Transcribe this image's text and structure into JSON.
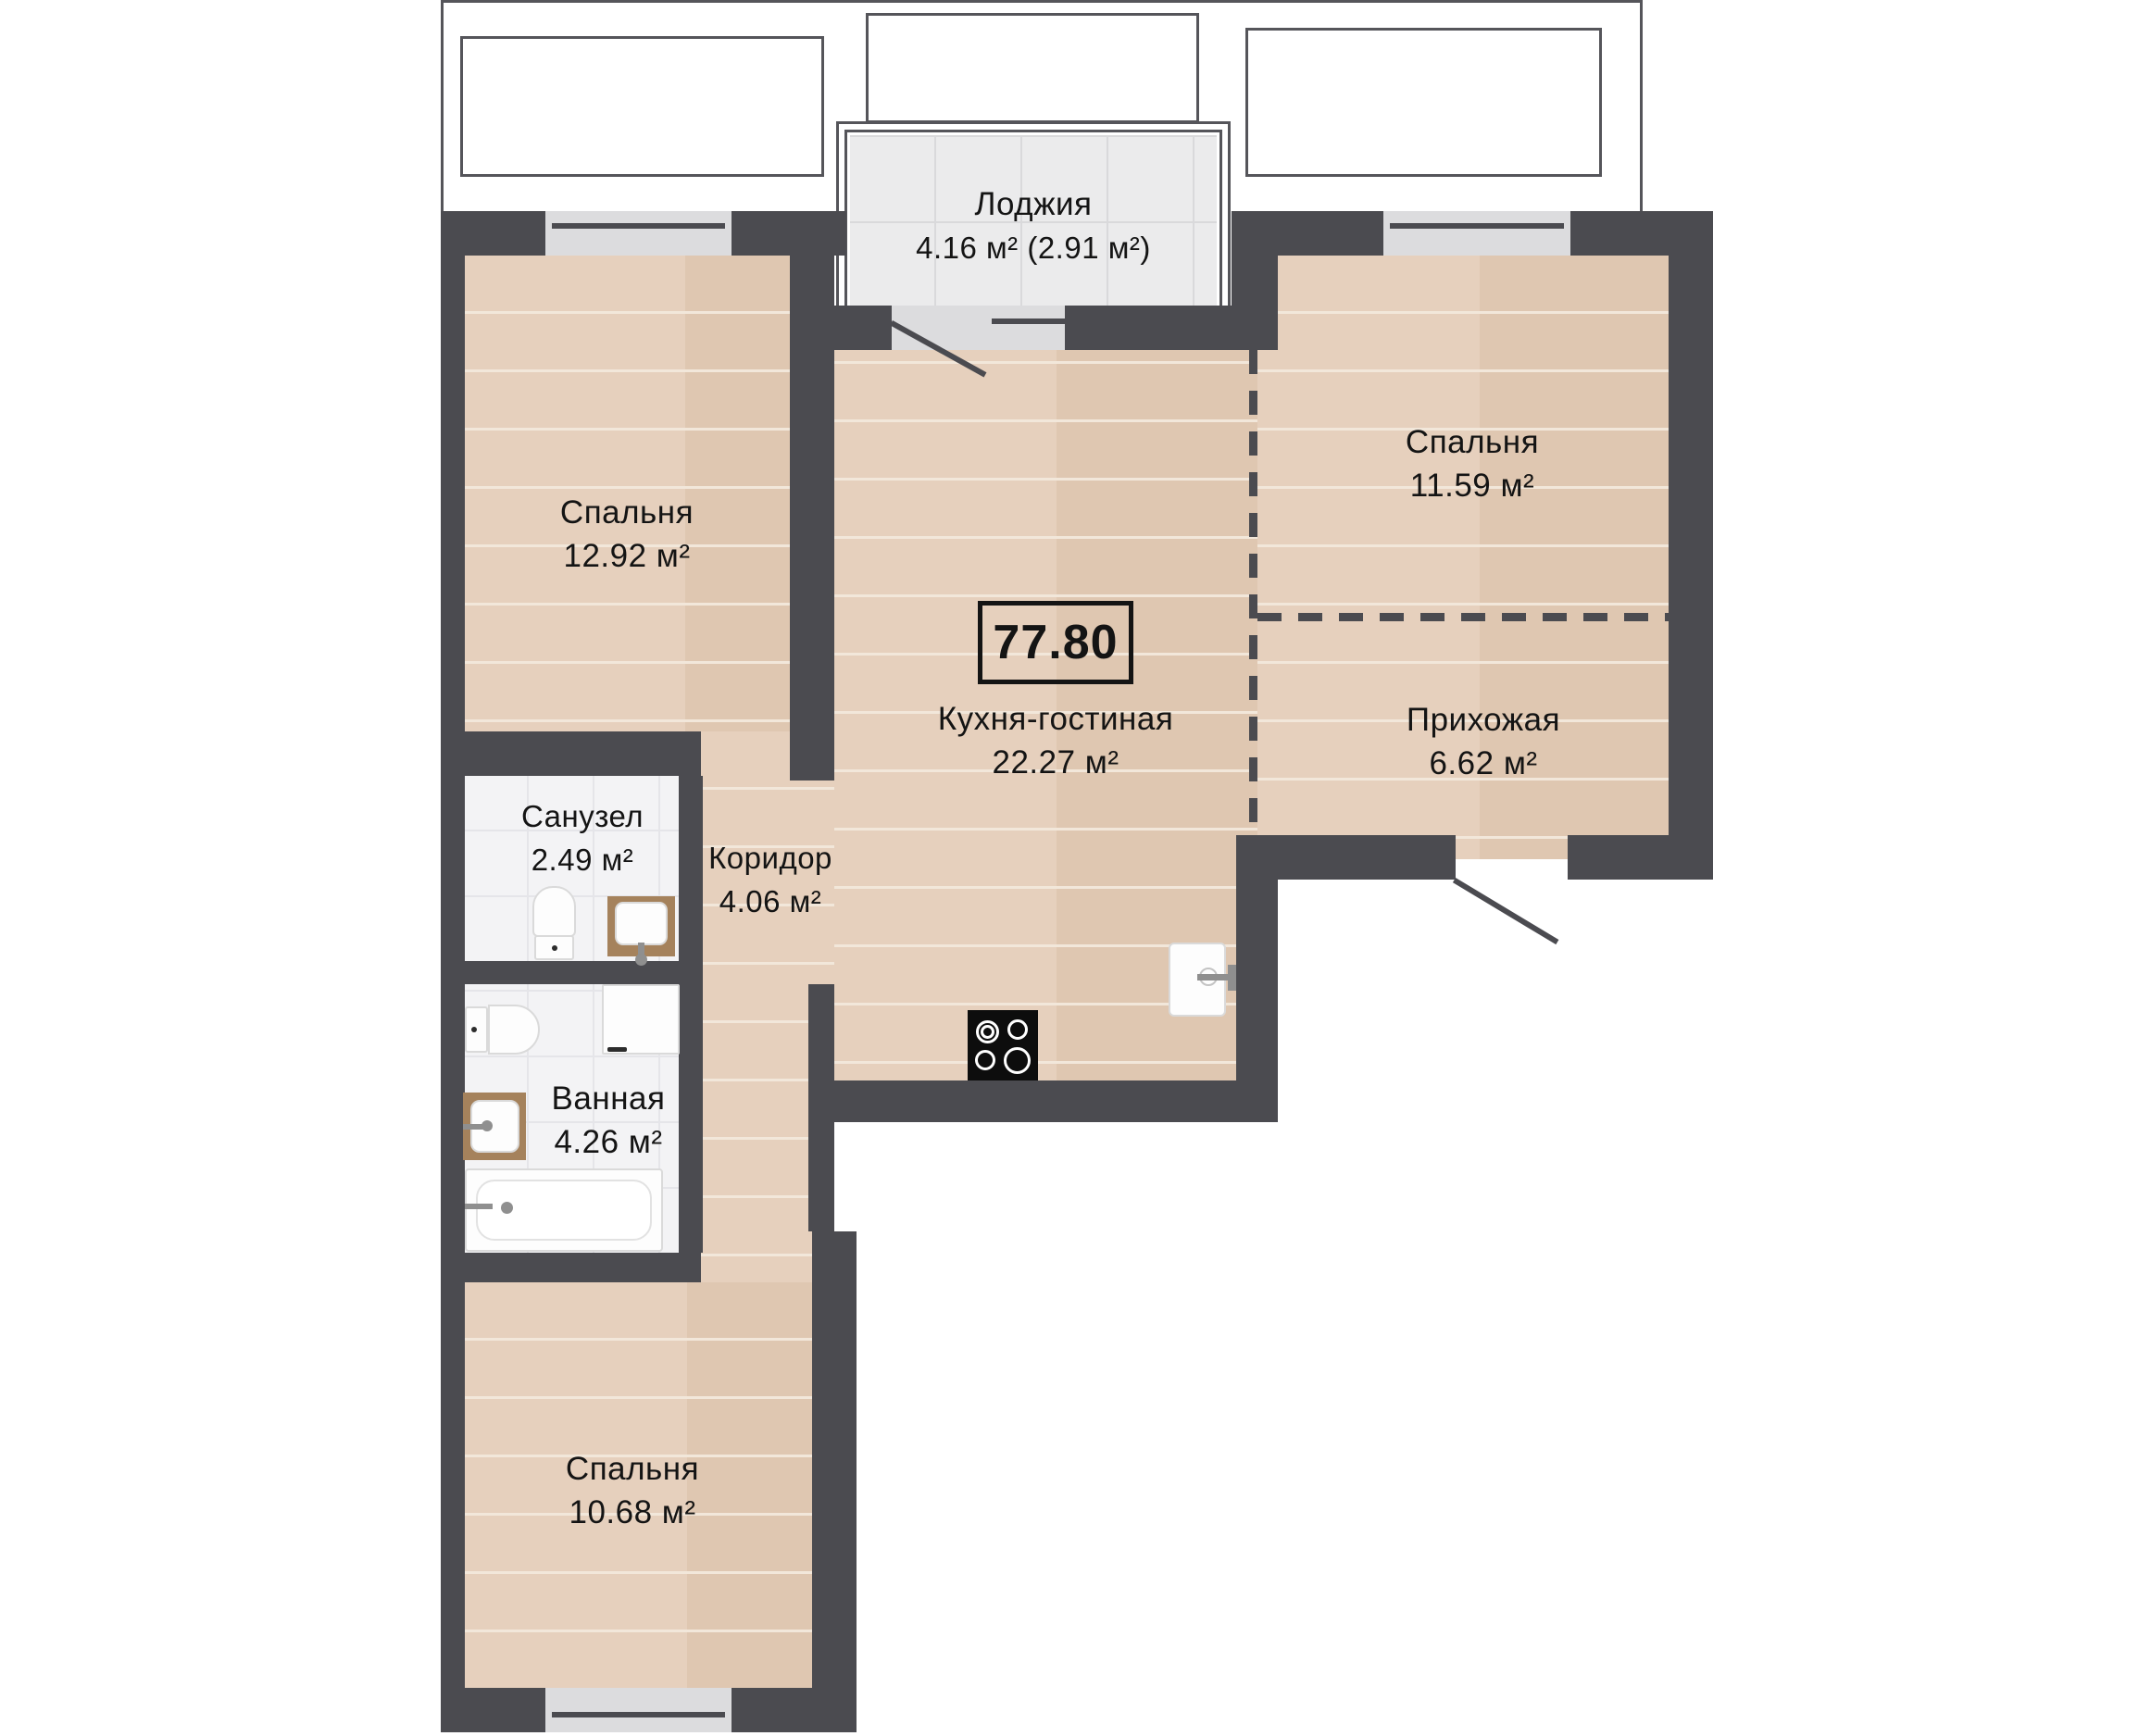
{
  "plan": {
    "title": "Apartment floor plan",
    "total_area": "77.80",
    "loggia": {
      "name": "Лоджия",
      "area": "4.16 м² (2.91 м²)"
    },
    "rooms": [
      {
        "id": "bedroom-top-left",
        "name": "Спальня",
        "area": "12.92 м²"
      },
      {
        "id": "bedroom-top-right",
        "name": "Спальня",
        "area": "11.59 м²"
      },
      {
        "id": "kitchen-living",
        "name": "Кухня-гостиная",
        "area": "22.27 м²"
      },
      {
        "id": "hallway",
        "name": "Прихожая",
        "area": "6.62 м²"
      },
      {
        "id": "wc",
        "name": "Санузел",
        "area": "2.49 м²"
      },
      {
        "id": "corridor",
        "name": "Коридор",
        "area": "4.06 м²"
      },
      {
        "id": "bathroom",
        "name": "Ванная",
        "area": "4.26 м²"
      },
      {
        "id": "bedroom-bottom",
        "name": "Спальня",
        "area": "10.68 м²"
      }
    ],
    "fixtures": [
      "toilet",
      "sink",
      "washing-machine",
      "bathtub",
      "stove",
      "kitchen-sink"
    ],
    "colors": {
      "wall": "#4b4b50",
      "wood_floor": "#e3ccb8",
      "loggia_tile": "#ebebec",
      "bath_tile": "#f3f3f5",
      "window_fill": "#dcdcde",
      "outline": "#55555a"
    }
  }
}
